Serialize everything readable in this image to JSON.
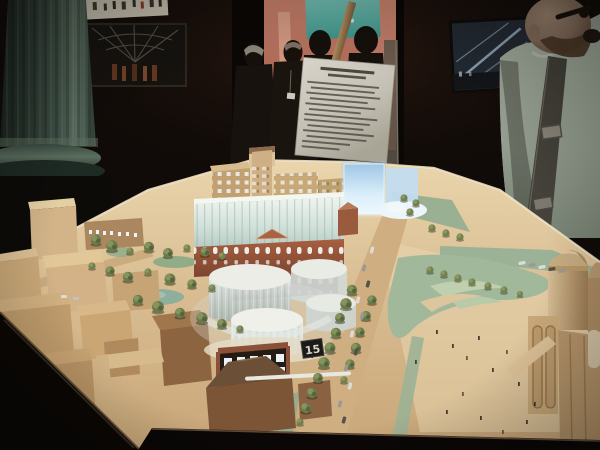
{
  "photo": {
    "marker_label": "15"
  },
  "scene_elements": [
    "classical-column",
    "framed-photo-crowd",
    "framed-picture-dome-interior",
    "gallery-doorway",
    "projection-screen",
    "doorway-visitors",
    "screen-silhouettes",
    "information-sign",
    "sign-stand-pole",
    "framed-picture-glass-roof",
    "photographer-visitor",
    "camera-strap",
    "architectural-model",
    "model-left-buildings",
    "museum-building",
    "glass-gallery-roof",
    "glowing-glass-slabs",
    "translucent-cylinder-buildings",
    "marker-15",
    "model-road",
    "model-cars",
    "model-trees",
    "model-park",
    "domed-building",
    "pedestrian-figures",
    "display-table-edge"
  ],
  "palette": {
    "room_shadow": "#100b08",
    "doorway_wall_salmon": "#b97260",
    "screen_teal": "#55aba0",
    "sign_paper": "#cbc7bc",
    "column_green_gray": "#46584c",
    "model_wood": "#d9bd92",
    "museum_brick": "#9a5838",
    "glass_glow_blue": "#cde4f4",
    "cylinder_glass": "#e2e8e5",
    "tree_olive": "#6b7a4b",
    "park_green": "#9eb497",
    "shirt_gray_green": "#99a395",
    "skin_tone": "#967d69"
  }
}
